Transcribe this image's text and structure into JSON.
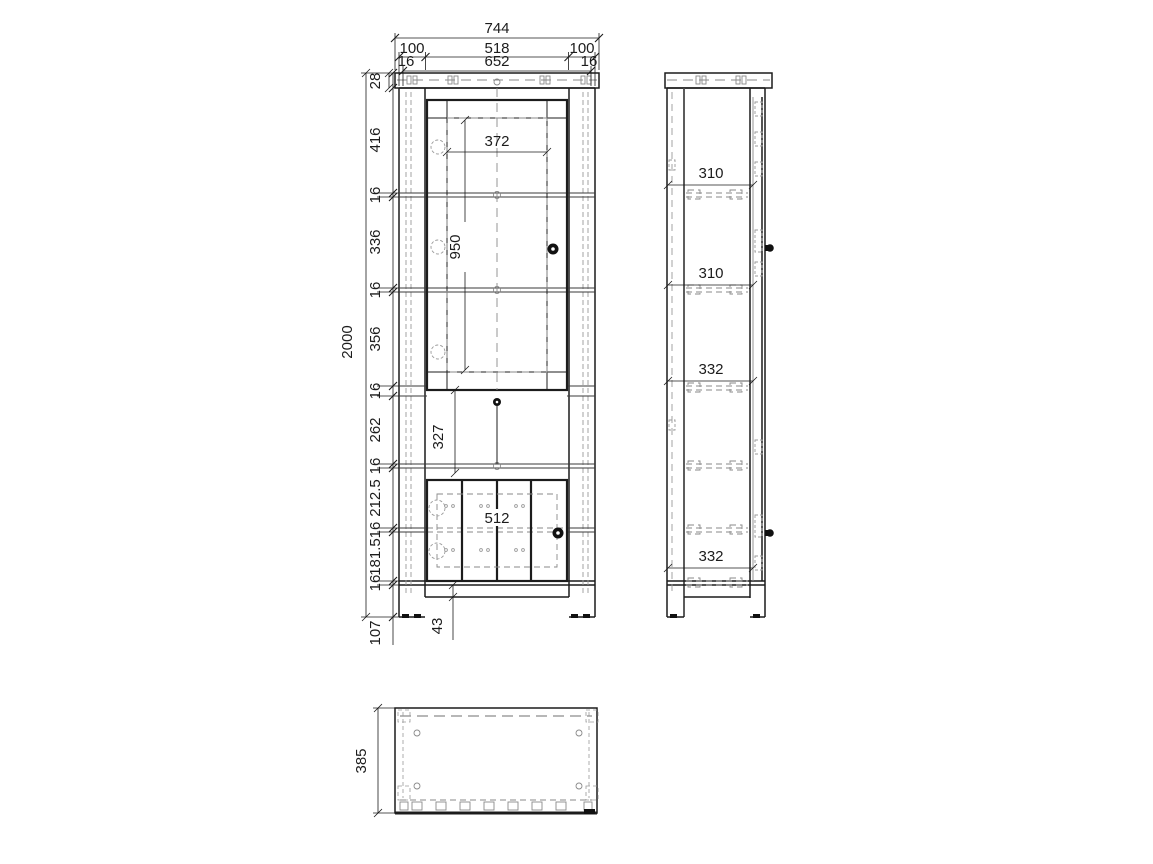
{
  "front_view": {
    "width_total": "744",
    "width_row2": [
      "100",
      "518",
      "100"
    ],
    "width_row3": [
      "16",
      "652",
      "16"
    ],
    "top_thickness": "28",
    "height_total": "2000",
    "height_chain": [
      "416",
      "16",
      "336",
      "16",
      "356",
      "16",
      "262",
      "16",
      "212.5",
      "16",
      "181.5",
      "16"
    ],
    "plinth_height": "107",
    "foot_height": "43",
    "glass_width": "372",
    "glass_height": "950",
    "open_height": "327",
    "lower_door_width": "512"
  },
  "side_view": {
    "shelf_gaps": [
      "310",
      "310",
      "332",
      "332"
    ]
  },
  "top_view": {
    "depth": "385"
  }
}
